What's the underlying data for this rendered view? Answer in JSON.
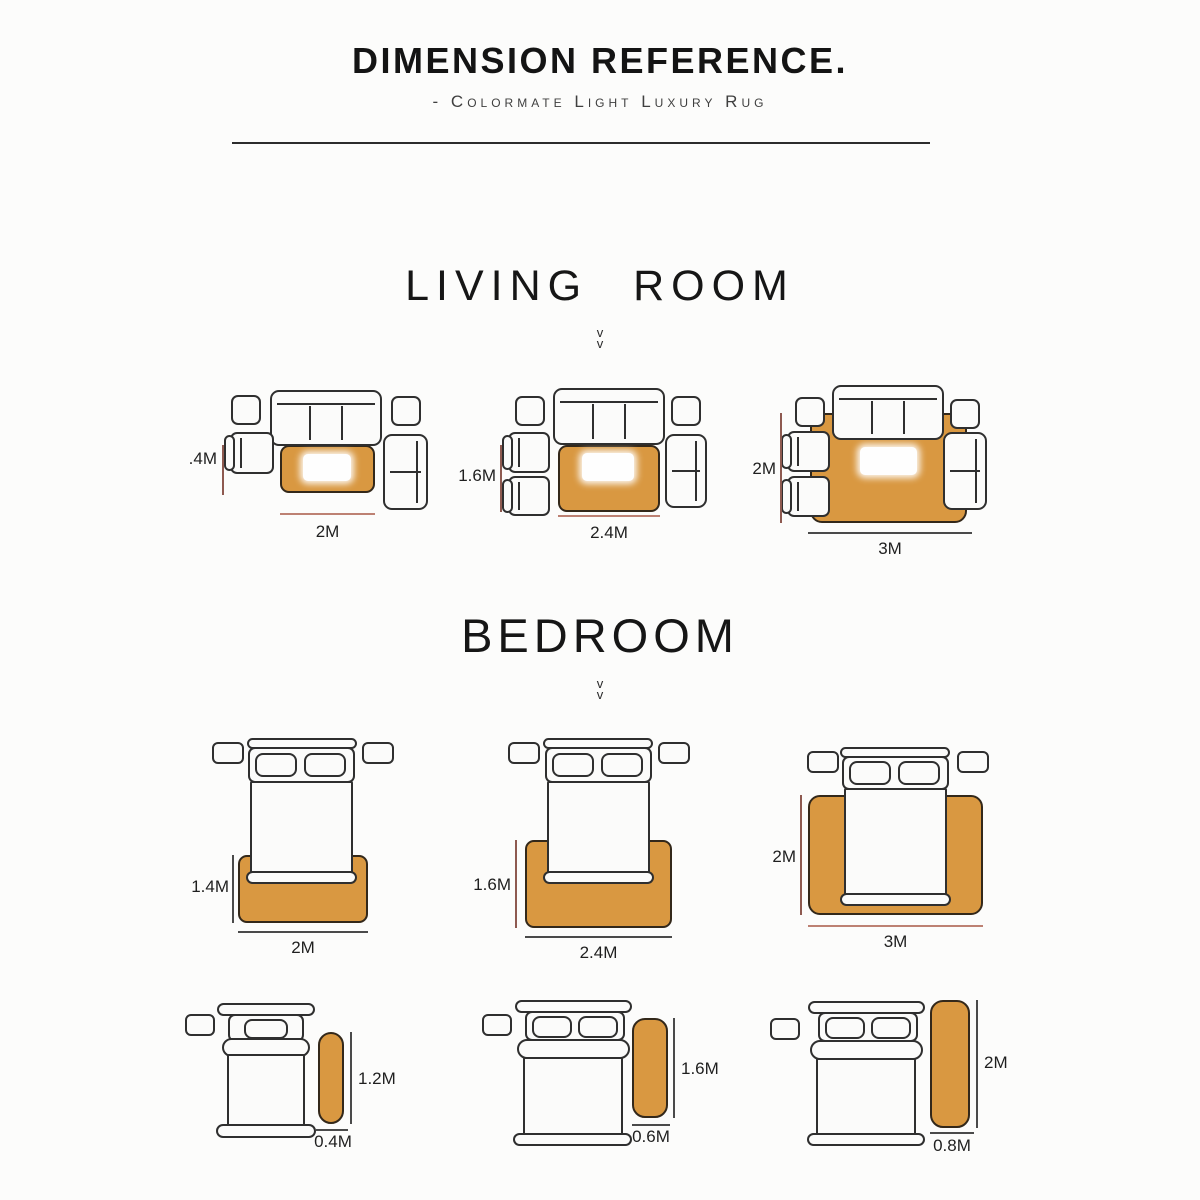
{
  "header": {
    "title": "DIMENSION REFERENCE.",
    "subtitle": "- Colormate Light Luxury Rug"
  },
  "icons": {
    "chevron_down": "v"
  },
  "sections": {
    "living": {
      "heading": "LIVING ROOM",
      "layouts": [
        {
          "height_label": ".4M",
          "width_label": "2M"
        },
        {
          "height_label": "1.6M",
          "width_label": "2.4M"
        },
        {
          "height_label": "2M",
          "width_label": "3M"
        }
      ]
    },
    "bedroom": {
      "heading": "BEDROOM",
      "bed_layouts": [
        {
          "height_label": "1.4M",
          "width_label": "2M"
        },
        {
          "height_label": "1.6M",
          "width_label": "2.4M"
        },
        {
          "height_label": "2M",
          "width_label": "3M"
        }
      ],
      "runner_layouts": [
        {
          "height_label": "1.2M",
          "width_label": "0.4M"
        },
        {
          "height_label": "1.6M",
          "width_label": "0.6M"
        },
        {
          "height_label": "2M",
          "width_label": "0.8M"
        }
      ]
    }
  },
  "colors": {
    "bg": "#fcfcfb",
    "rug_fill": "#d99841",
    "rug_border": "#33281a",
    "furniture_fill": "#fbfbfa",
    "outline": "#2f2f2f",
    "line_red_v": "#8e5a50",
    "line_red_h": "#bd8173",
    "line_dark": "#4a4a4a",
    "text_dark": "#1f1f1f"
  }
}
